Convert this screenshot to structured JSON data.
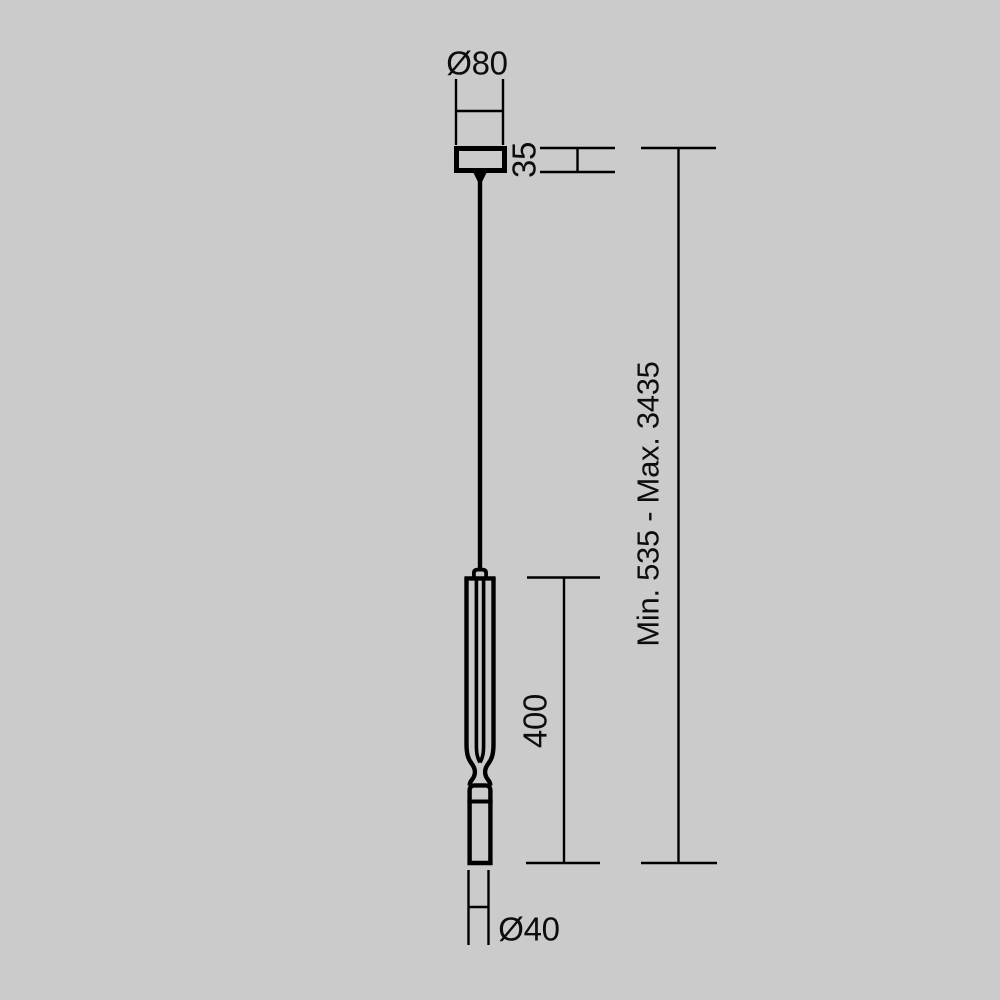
{
  "diagram": {
    "kind": "pendant-light-dimension-drawing",
    "colors": {
      "background": "#cbcbcb",
      "line": "#000000",
      "text": "#0d0d0d"
    },
    "dimensions": {
      "canopy_diameter": {
        "label": "Ø80",
        "value_mm": 80
      },
      "canopy_height": {
        "label": "35",
        "value_mm": 35
      },
      "suspension_range": {
        "label": "Min. 535 - Max. 3435",
        "min_mm": 535,
        "max_mm": 3435
      },
      "shade_height": {
        "label": "400",
        "value_mm": 400
      },
      "shade_diameter": {
        "label": "Ø40",
        "value_mm": 40
      }
    }
  }
}
